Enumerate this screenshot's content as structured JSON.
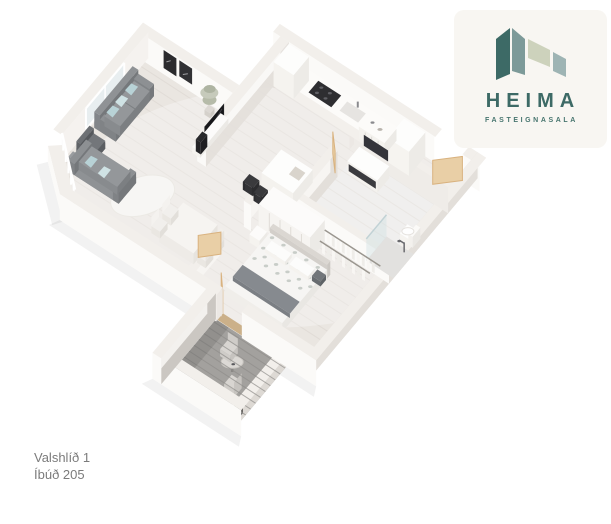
{
  "brand": {
    "name": "HEIMA",
    "subtitle": "FASTEIGNASALA",
    "teal": "#3d6a66",
    "teal_mid": "#7d9a99",
    "sage": "#cdd2bc",
    "grayblue": "#9eb4b4",
    "card_bg": "#f8f6f2"
  },
  "caption": {
    "line1": "Valshlíð 1",
    "line2": "Íbúð 205",
    "color": "#7b7b7b"
  },
  "palette": {
    "floor": "#eae6e1",
    "plank": "#dcd7d1",
    "tile": "#eae9e7",
    "wallTop": "#f2efeb",
    "wallBright": "#fbfaf8",
    "wallFaceE": "#f5f2ef",
    "wallFaceW": "#e3dfda",
    "wallCap": "#ece8e4",
    "balconyFloor": "#a3a19e",
    "balconyPlank": "#8f8d8a",
    "wood": "#e9cfa6",
    "woodEdge": "#d9b27f",
    "sofa": "#898c8f",
    "sofaDark": "#75787b",
    "chairDark": "#63666a",
    "pillow": "#b8d2d6",
    "pillowLight": "#cfe2e4",
    "dark": "#2e2e31",
    "white": "#ffffff"
  }
}
